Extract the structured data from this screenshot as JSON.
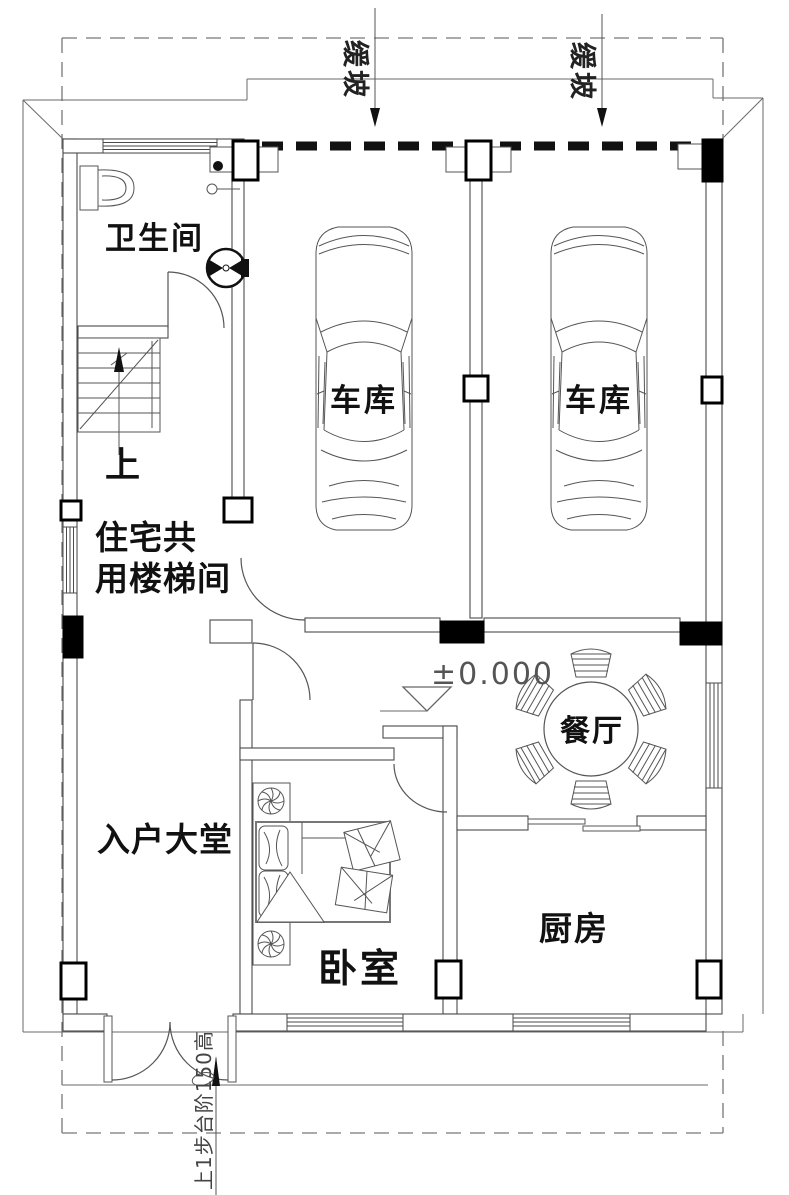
{
  "floor_plan": {
    "type": "architectural-floor-plan",
    "rooms": [
      {
        "id": "bathroom",
        "label": "卫生间"
      },
      {
        "id": "garage-left",
        "label": "车库"
      },
      {
        "id": "garage-right",
        "label": "车库"
      },
      {
        "id": "stairwell",
        "label_line1": "住宅共",
        "label_line2": "用楼梯间"
      },
      {
        "id": "entrance-hall",
        "label": "入户大堂"
      },
      {
        "id": "dining-room",
        "label": "餐厅"
      },
      {
        "id": "bedroom",
        "label": "卧室"
      },
      {
        "id": "kitchen",
        "label": "厨房"
      }
    ],
    "annotations": {
      "stair_direction": "上",
      "slope_left": "缓坡",
      "slope_right": "缓坡",
      "floor_elevation": "±0.000",
      "entry_step_note": "上1步台阶150高"
    },
    "colors": {
      "background": "#ffffff",
      "line": "#4a4a4a",
      "heavy_line": "#111111",
      "label_text": "#111111",
      "dim_text": "#555555"
    }
  }
}
